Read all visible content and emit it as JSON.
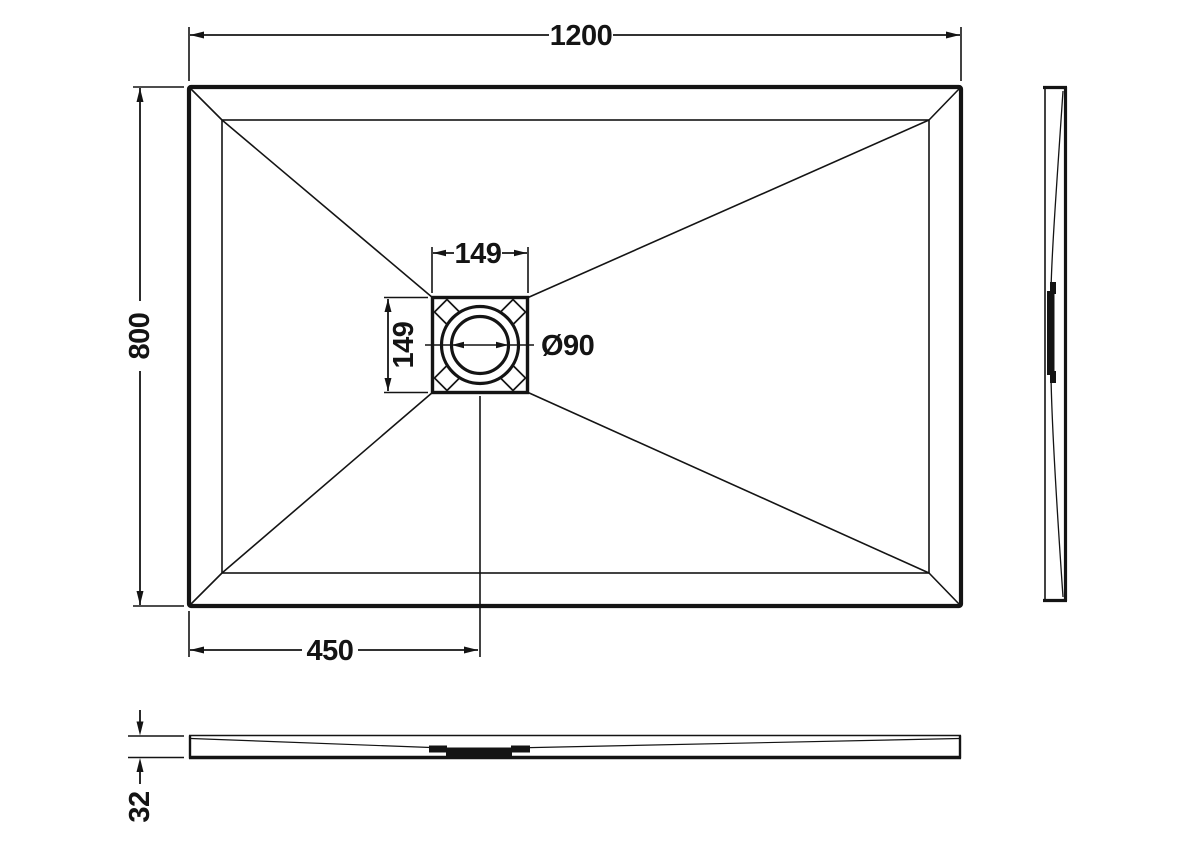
{
  "colors": {
    "background": "#ffffff",
    "line": "#141414"
  },
  "dimensions": {
    "overall_width": "1200",
    "overall_depth": "800",
    "waste_recess_width": "149",
    "waste_recess_depth": "149",
    "waste_diameter": "Ø90",
    "waste_centre_from_left": "450",
    "tray_thickness": "32"
  }
}
